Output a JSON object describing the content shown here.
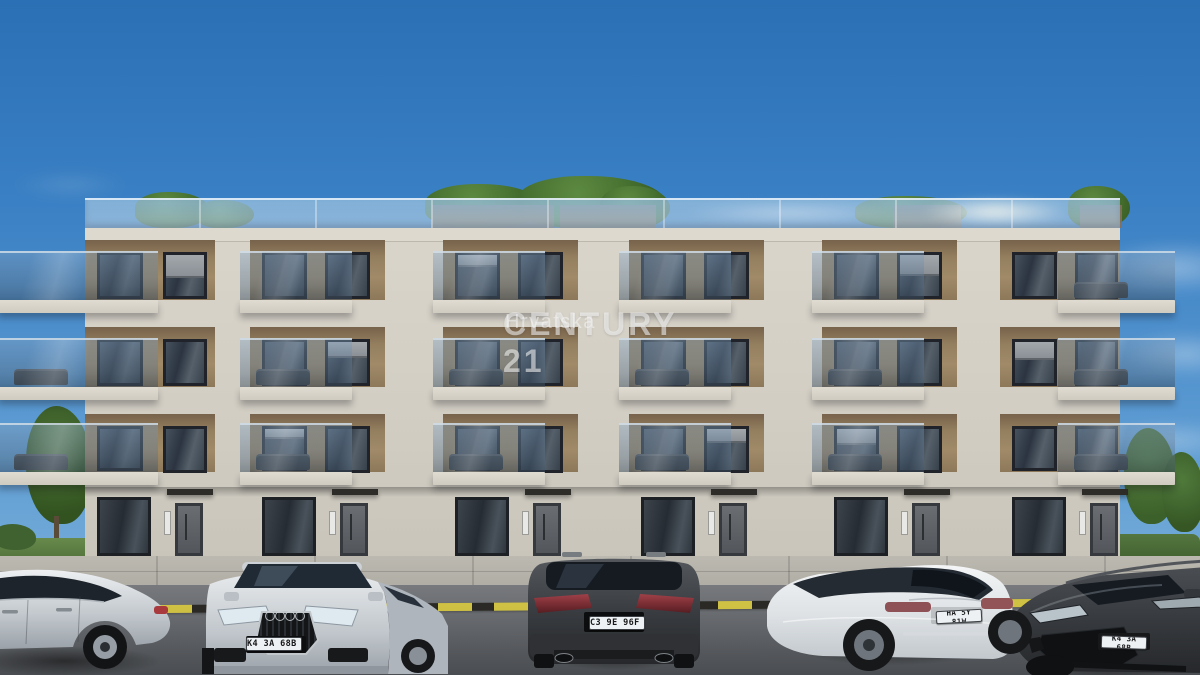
{
  "watermark": {
    "brand": "CENTURY 21",
    "region": "Hrvatska"
  },
  "vehicles": {
    "silver_suv_plate": "K4 3A 68B",
    "dark_wagon_plate": "C3 9E 96F",
    "white_sedan_plate": "HA 5Y 81W",
    "dark_hatch_plate": "K4 3A 68B"
  },
  "palette": {
    "sky_top": "#2b6fb4",
    "sky_horizon": "#85b8df",
    "facade_cream": "#d2cec4",
    "facade_accent_brown": "#937e5e",
    "balcony_glass": "#8fb0c9",
    "roof_greenery": "#46702f",
    "asphalt": "#65686c",
    "marking_yellow": "#d7c83f",
    "plate_blue_band": "#2257a5"
  }
}
